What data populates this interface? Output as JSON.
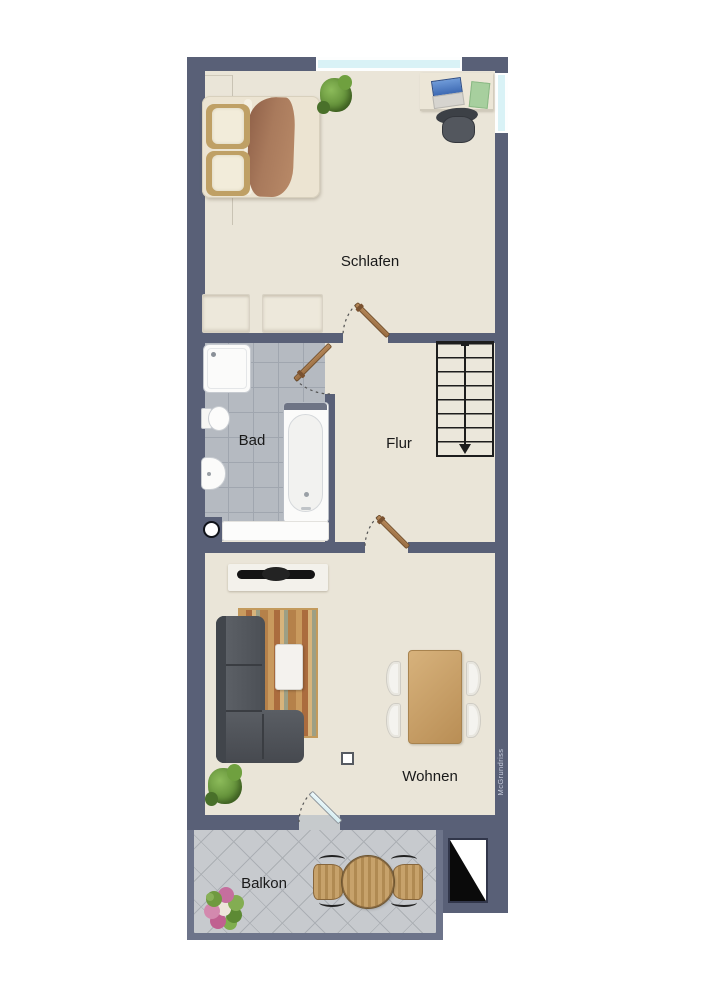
{
  "floorplan": {
    "watermark": "McGrundriss",
    "rooms": [
      {
        "id": "bedroom",
        "label": "Schlafen"
      },
      {
        "id": "bathroom",
        "label": "Bad"
      },
      {
        "id": "hallway",
        "label": "Flur"
      },
      {
        "id": "living",
        "label": "Wohnen"
      },
      {
        "id": "balcony",
        "label": "Balkon"
      }
    ],
    "stairs": {
      "steps": 8,
      "direction": "down"
    },
    "doors": {
      "wood_doors": 3,
      "glass_balcony_door": 1
    },
    "windows": {
      "bedroom_top": 1,
      "bedroom_right": 1
    },
    "furniture": {
      "bedroom": [
        "wardrobe",
        "double-bed",
        "plant",
        "desk",
        "laptop",
        "notepad",
        "office-chair",
        "dresser",
        "dresser"
      ],
      "bathroom": [
        "shower",
        "toilet",
        "bidet",
        "bathtub",
        "radiator",
        "floor-drain"
      ],
      "hallway": [
        "staircase"
      ],
      "living": [
        "tv-sideboard",
        "tv",
        "rug",
        "corner-sofa",
        "coffee-table",
        "plant",
        "dining-table",
        "dining-chairs",
        "floor-marker"
      ],
      "balcony": [
        "round-table",
        "garden-chair",
        "garden-chair",
        "flower-pot"
      ],
      "exterior": [
        "shaft-symbol"
      ]
    },
    "colors": {
      "wall": "#596077",
      "balcony_wall": "#6d748a",
      "floor": "#eae5d8",
      "bath_tile": "#b5bac1",
      "balcony_tile": "#c7cace",
      "window_glass": "#d9f2f6",
      "door_wood": "#a8794c",
      "stairs_line": "#1d1d1d"
    }
  }
}
